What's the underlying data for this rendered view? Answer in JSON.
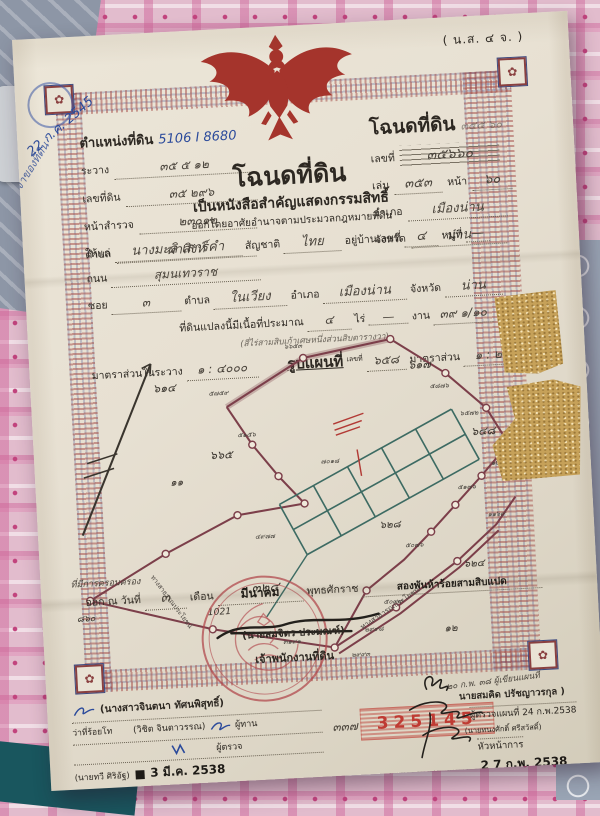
{
  "photo": {
    "corner_date": "22 ก.ค. 2545",
    "side_note": "ฉบับเจ้าของที่ดิน"
  },
  "form_code": "( น.ส. ๔ จ. )",
  "position_block": {
    "title_label": "ตำแหน่งที่ดิน",
    "title_value": "5106 I 8680",
    "fields": [
      {
        "label": "ระวาง",
        "value": "๓๕ ๕ ๑๒"
      },
      {
        "label": "เลขที่ดิน",
        "value": "๓๕  ๒๙๖"
      },
      {
        "label": "หน้าสำรวจ",
        "value": "๒๓๐๑๒"
      },
      {
        "label": "ตำบล",
        "value": "ผาสิงห์"
      }
    ]
  },
  "deed_block": {
    "title": "โฉนดที่ดิน",
    "pencil_note": "๓๕๕ ๖๐",
    "no_label": "เลขที่",
    "no_value": "๓๕๖๖๐",
    "book_label": "เล่ม",
    "book_value": "๓๕๓",
    "page_label": "หน้า",
    "page_value": "๖๐",
    "amphoe_label": "อำเภอ",
    "amphoe_value": "เมืองน่าน",
    "province_label": "จังหวัด",
    "province_value": "น่าน"
  },
  "title_block": {
    "heading": "โฉนดที่ดิน",
    "subheading": "เป็นหนังสือสำคัญแสดงกรรมสิทธิ์",
    "authority_line": "ออกโดยอาศัยอำนาจตามประมวลกฎหมายที่ดิน"
  },
  "grantee_block": {
    "given_label": "ให้แก่",
    "given_value": "นางมะลิ เสาร์คำ",
    "nationality_label": "สัญชาติ",
    "nationality_value": "ไทย",
    "address_label": "อยู่บ้านเลขที่",
    "address_value": "๔",
    "moo_label": "หมู่ที่",
    "moo_value": "—",
    "road_label": "ถนน",
    "road_value": "สุมนเทวราช",
    "soi_label": "ซอย",
    "soi_value": "๓",
    "tambon_label": "ตำบล",
    "tambon_value": "ในเวียง",
    "amphoe_label": "อำเภอ",
    "amphoe_value": "เมืองน่าน",
    "province_label": "จังหวัด",
    "province_value": "น่าน",
    "area_label": "ที่ดินแปลงนี้มีเนื้อที่ประมาณ",
    "rai_value": "๔",
    "rai_label": "ไร่",
    "ngan_value": "—",
    "ngan_label": "งาน",
    "wa_value": "๓๙ ๑/๑๐",
    "wa_label": "ตารางวา",
    "area_words": "(สี่ไร่สามสิบเก้าเศษหนึ่งส่วนสิบตารางวา)",
    "scale_label": "มาตราส่วนในระวาง",
    "scale_value": "๑ : ๔๐๐๐",
    "map_title": "รูปแผนที่",
    "map_no_label": "เลขที่",
    "map_no_value": "๖๕๘",
    "map_scale_label": "มาตราส่วน",
    "map_scale_value": "๑ : ๒๐๐๐"
  },
  "map": {
    "region_labels": [
      "๖๑๔",
      "๖๖๕",
      "๑๑",
      "๖๑๗",
      "๖๔๘",
      "๖๒๘",
      "๖๒๔",
      "๓๒๔",
      "๑๒",
      "๘๖๐",
      "1021"
    ],
    "point_labels": [
      "๖๖๕๓",
      "๕๗๕๙",
      "๕๑๕๖",
      "๗๐๑๘",
      "๕๘๗๖",
      "๖๕๗๒",
      "๑๒๑๒",
      "๑๑๖๙",
      "๕๐๗๖",
      "๕๑๗๖",
      "๓๑๙๑",
      "๒๙๙๓",
      "๔๙๗๗",
      "๕๐๙๙",
      "๒๙๙๘",
      "๗๒๗๖"
    ],
    "road_label_1": "ทางสาธารณประโยชน์",
    "road_label_2": "ทางสาธารณประโยชน์"
  },
  "issue_block": {
    "hand_note": "ที่มีการครอบครอง",
    "issued_label": "ออก ณ วันที่",
    "day_value": "๓",
    "month_label": "เดือน",
    "month_value": "มีนาคม",
    "era_label": "พุทธศักราช",
    "year_value": "สองพันห้าร้อยสามสิบแปด"
  },
  "seal_block": {
    "officer_name": "(นายสมจิตร ประมณฑ์)",
    "officer_title": "เจ้าพนักงานที่ดิน"
  },
  "footer": {
    "left": {
      "name1": "(นางสาวจินตนา ทัศนพิสุทธิ์)",
      "rank": "ว่าที่ร้อยโท",
      "name2": "(วิชิต จินตาวรรณ)",
      "role2": "ผู้ทาน",
      "role3": "ผู้ตรวจ",
      "name3": "(นายทวี ศิริอัฐ)",
      "date_stamp": "3 มี.ค. 2538"
    },
    "serial": {
      "hand": "๓๓๗",
      "number": "325145"
    },
    "right": {
      "pencil_note": "๒๐ ก.พ. ๓๘  ผู้เขียนแผนที่",
      "name1": "นายสมคิด ปรัชญาวรกุล )",
      "role1": "ผู้ตรวจแผนที่ 24 ก.พ.2538",
      "name2": "(นายทนงศักดิ์ ศรีสวัสดิ์)",
      "role2": "หัวหน้าการ",
      "date_stamp": "2 7 ก.พ. 2538",
      "name3": "นายวรรเพชร ชมพลบุตร"
    }
  },
  "colors": {
    "garuda_red": "#a5342c",
    "seal_red": "#b24a4e",
    "stamp_red": "#bf3b33",
    "ink_blue": "#2b4a9b",
    "pencil": "#4a443c",
    "map_maroon": "#7c3f4a",
    "map_teal": "#3d6b63",
    "paper": "#e9e3d6"
  }
}
